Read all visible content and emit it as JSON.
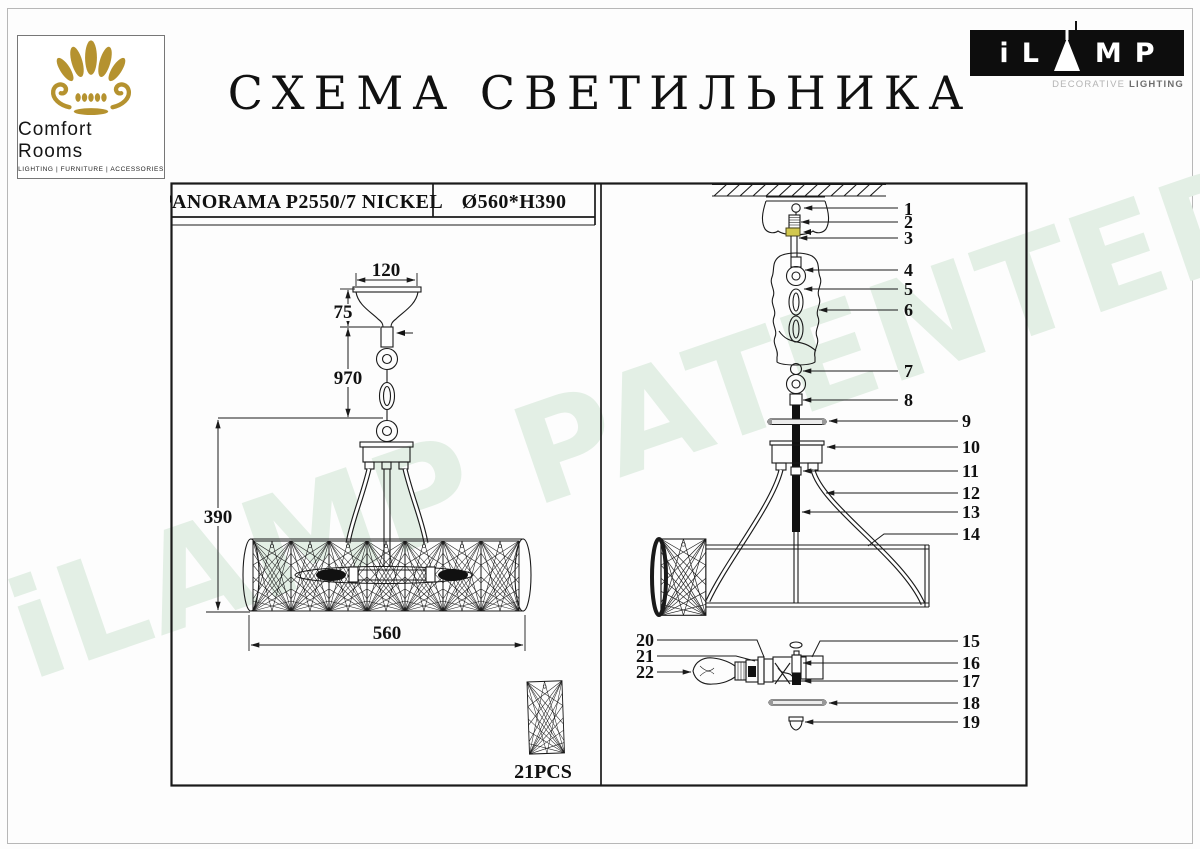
{
  "page_title": "СХЕМА СВЕТИЛЬНИКА",
  "logos": {
    "comfort_rooms": {
      "name": "Comfort Rooms",
      "tagline": "LIGHTING | FURNITURE | ACCESSORIES"
    },
    "ilamp": {
      "letter_i": "i",
      "letter_l": "L",
      "letter_m": "M",
      "letter_p": "P",
      "subtitle_light": "DECORATIVE ",
      "subtitle_bold": "LIGHTING"
    }
  },
  "watermark": {
    "text": "iLAMP PATENTED",
    "color": "#e3efe5"
  },
  "spec": {
    "model": "PANORAMA P2550/7 NICKEL",
    "dimensions": "Ø560*H390"
  },
  "dims": {
    "canopy_width": "120",
    "canopy_height": "75",
    "suspension_length": "970",
    "body_height": "390",
    "body_diameter": "560"
  },
  "crystal_count": "21PCS",
  "callouts": [
    "1",
    "2",
    "3",
    "4",
    "5",
    "6",
    "7",
    "8",
    "9",
    "10",
    "11",
    "12",
    "13",
    "14",
    "15",
    "16",
    "17",
    "18",
    "19",
    "20",
    "21",
    "22"
  ],
  "colors": {
    "gold": "#b5922f",
    "line": "#1a1a1a",
    "part3_yellow": "#d2c84e",
    "watermark_green": "#e3efe5"
  }
}
